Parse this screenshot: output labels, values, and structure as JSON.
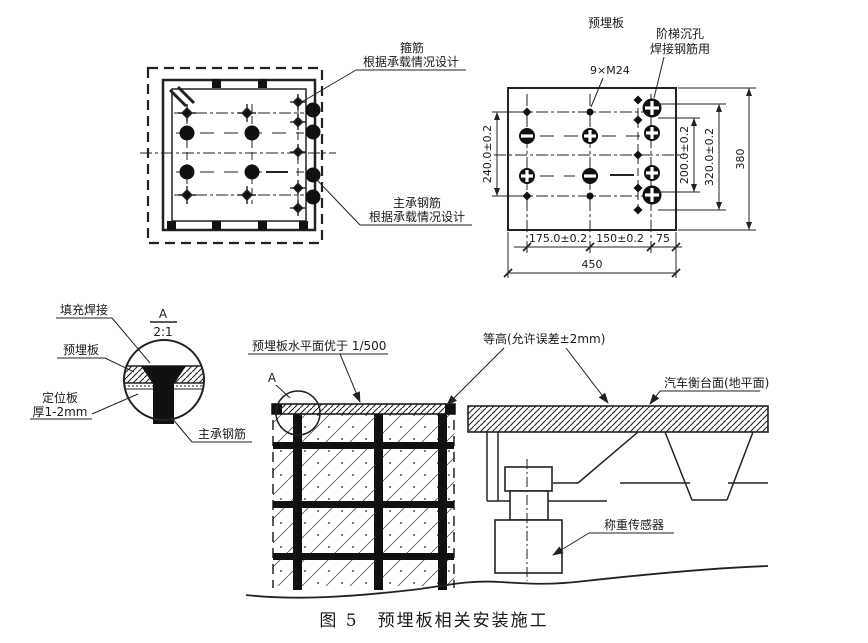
{
  "colors": {
    "ink": "#1a1a1a",
    "background": "#ffffff"
  },
  "plan_view": {
    "stirrup_label_line1": "箍筋",
    "stirrup_label_line2": "根据承载情况设计",
    "main_rebar_label_line1": "主承钢筋",
    "main_rebar_label_line2": "根据承载情况设计"
  },
  "plate_view": {
    "title": "预埋板",
    "bolt_spec": "9×M24",
    "counterbore_label_line1": "阶梯沉孔",
    "counterbore_label_line2": "焊接钢筋用",
    "dim_height_outer": "240.0±0.2",
    "dim_height_inner": "200.0±0.2",
    "dim_height_mid": "320.0±0.2",
    "dim_height_total": "380",
    "dim_width_seg1": "175.0±0.2",
    "dim_width_seg2": "150±0.2",
    "dim_width_seg3": "75",
    "dim_width_total": "450"
  },
  "detail_view": {
    "ref_letter": "A",
    "scale": "2:1",
    "fill_weld_label": "填充焊接",
    "embedded_plate_label": "预埋板",
    "locator_plate_label_line1": "定位板",
    "locator_plate_label_line2": "厚1-2mm",
    "main_rebar_label": "主承钢筋"
  },
  "section_view": {
    "detail_ref_label": "A",
    "levelness_label": "预埋板水平面优于 1/500",
    "equal_height_label": "等高(允许误差±2mm)",
    "platform_label": "汽车衡台面(地平面)",
    "load_cell_label": "称重传感器"
  },
  "caption": "图 5　预埋板相关安装施工"
}
